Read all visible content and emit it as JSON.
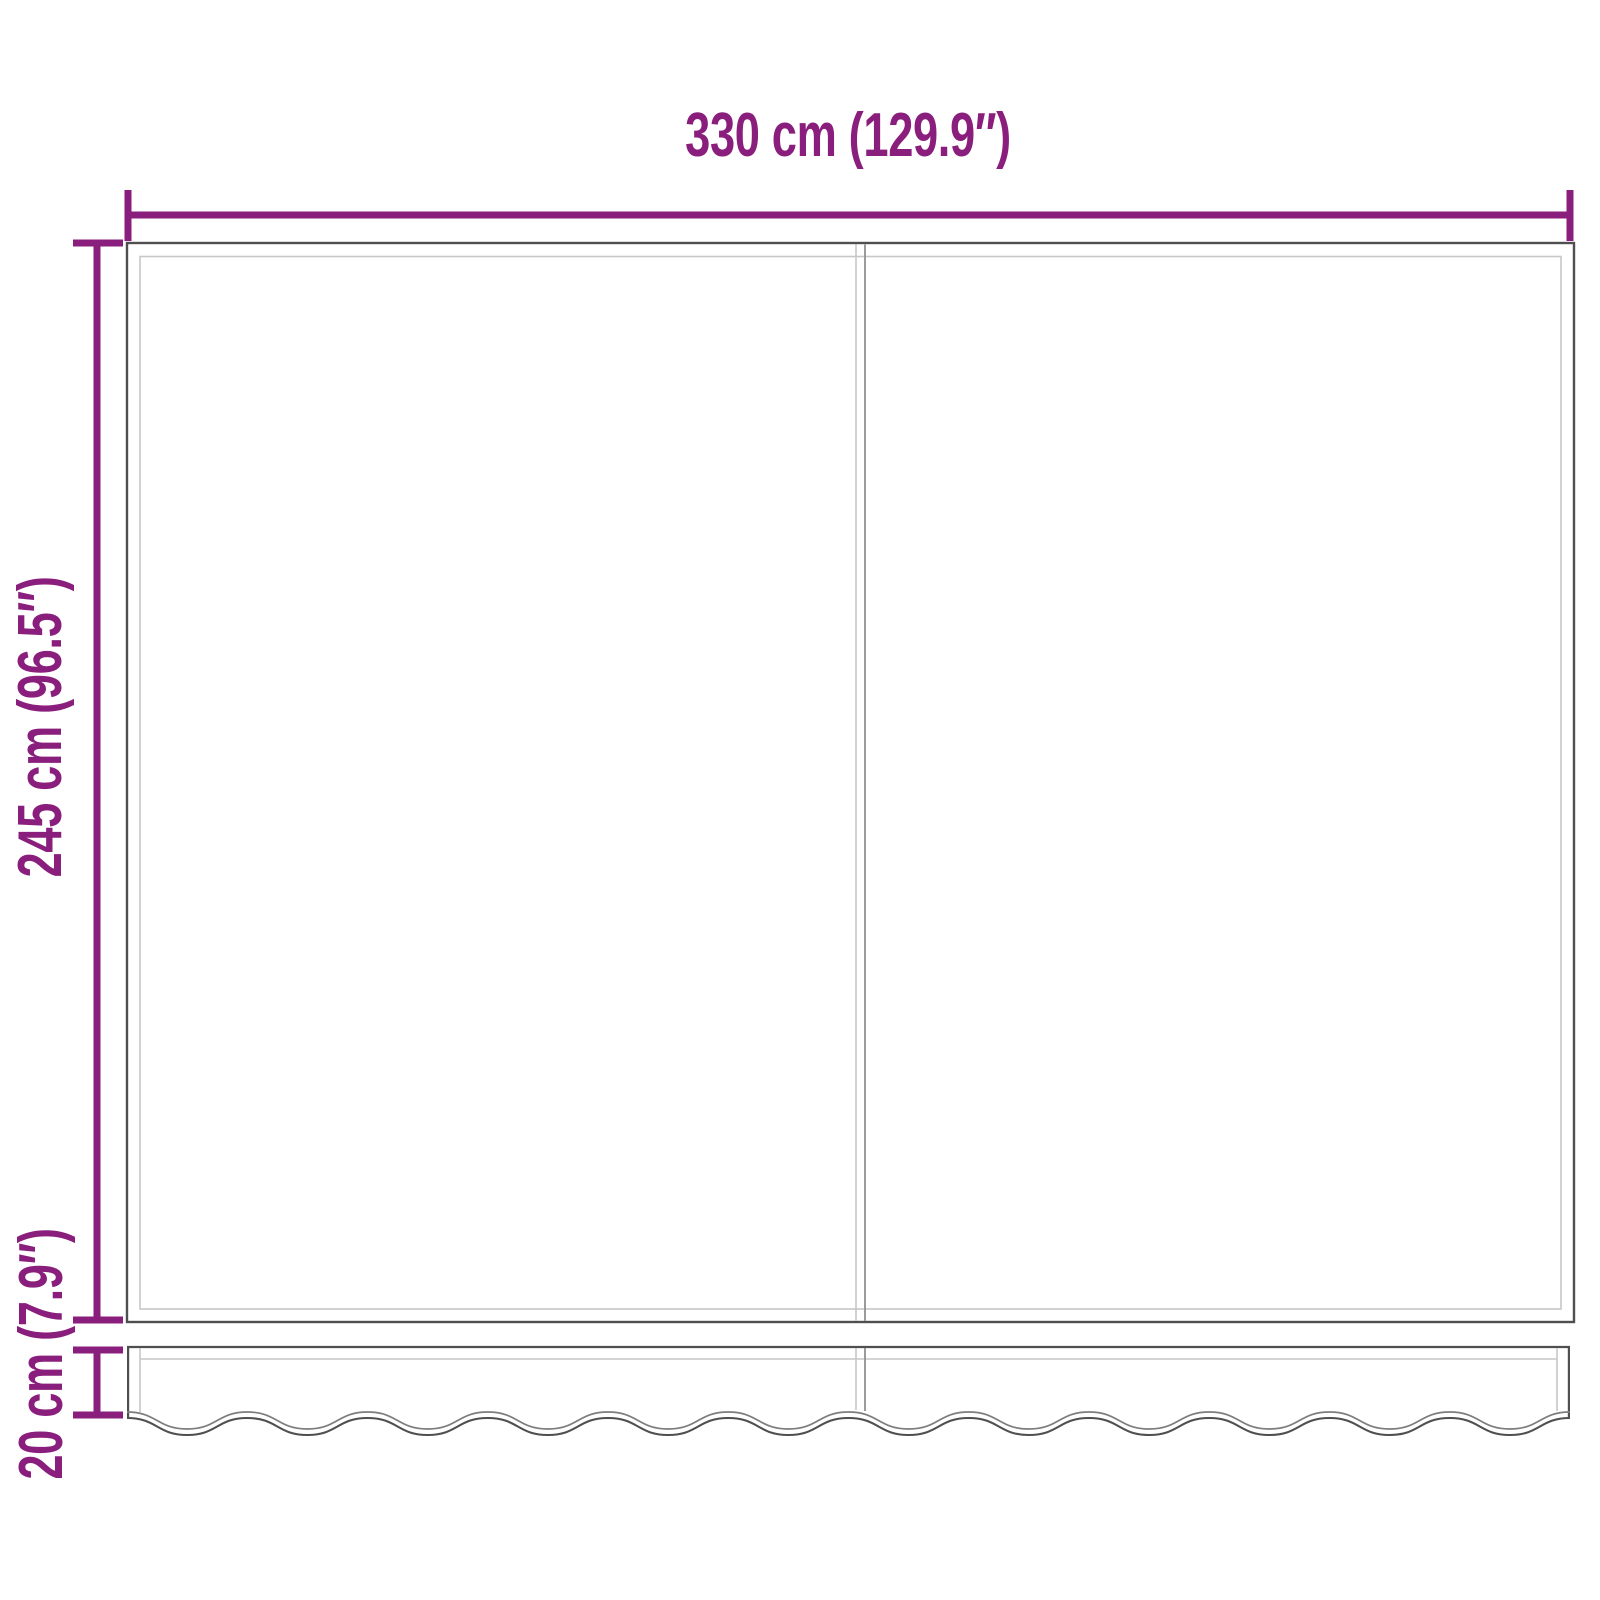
{
  "diagram": {
    "labels": {
      "width": "330 cm (129.9″)",
      "height": "245 cm (96.5″)",
      "valance": "20 cm (7.9″)"
    },
    "colors": {
      "dimension": "#8A1E7D",
      "outline_dark": "#4F4F4F",
      "outline_mid": "#909090",
      "outline_light": "#C7C7C7",
      "wave_inner": "#7D7D7D",
      "background": "#FFFFFF"
    }
  }
}
